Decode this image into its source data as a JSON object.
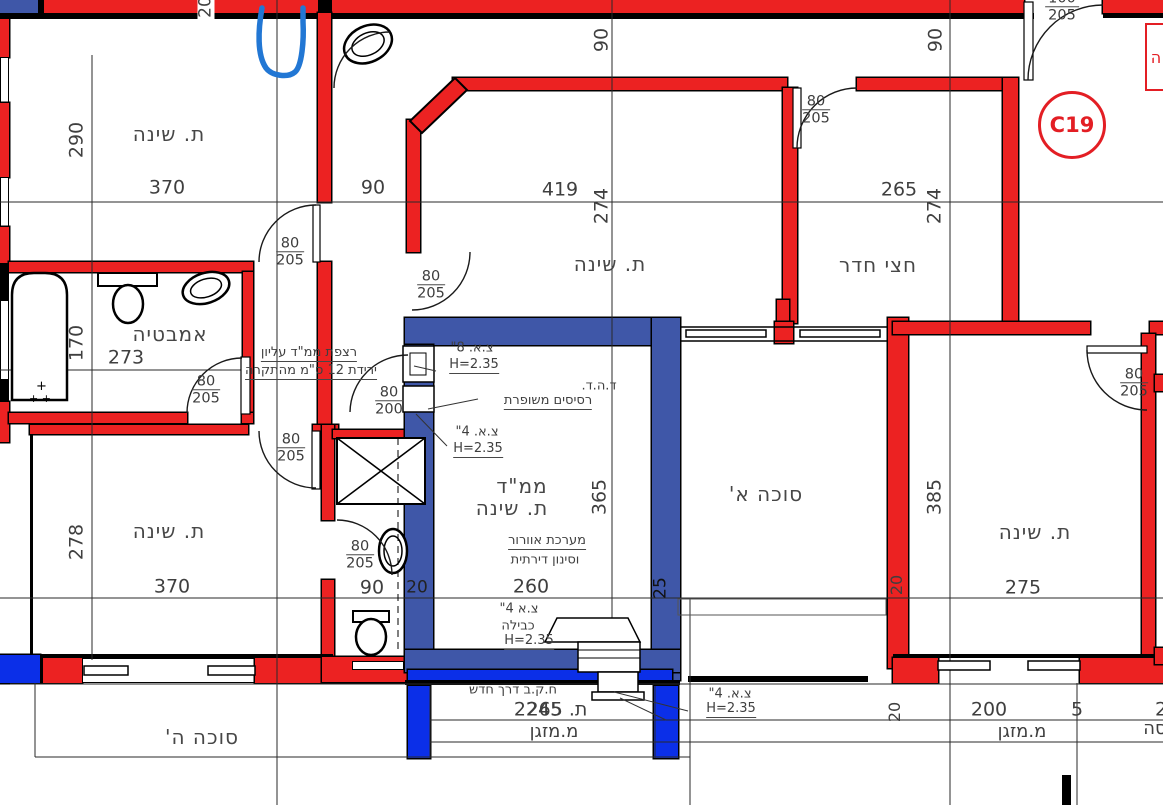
{
  "colors": {
    "wall_red": "#ec2222",
    "wall_blue": "#3f57a8",
    "wall_blue_bright": "#0b2fe8",
    "marker_red": "#e31e24",
    "sketch_blue": "#2277d4"
  },
  "marker": {
    "label": "C19",
    "partial_right_box": "ה"
  },
  "rooms": {
    "bedroom_top_left": {
      "label": "ת. שינה"
    },
    "bedroom_middle": {
      "label": "ת. שינה"
    },
    "half_room": {
      "label": "חצי חדר"
    },
    "bathroom": {
      "label": "אמבטיה"
    },
    "bedroom_bottom_left": {
      "label": "ת. שינה"
    },
    "bedroom_right": {
      "label": "ת. שינה"
    },
    "mamad": {
      "label_line1": "ממ\"ד",
      "label_line2": "ת. שינה"
    },
    "sukkah_a": {
      "label": "סוכה א'"
    },
    "sukkah_h": {
      "label": "סוכה ה'"
    },
    "ac_left": {
      "label": "מ.מזגן"
    },
    "ac_right": {
      "label": "מ.מזגן"
    }
  },
  "door_sizes": {
    "standard_width": "80",
    "standard_height": "205",
    "mamad_height": "200",
    "entry_width": "100"
  },
  "dims": {
    "tl_w": "370",
    "tl_h": "290",
    "tl_gap": "90",
    "top_cut": "20",
    "mid_w": "419",
    "mid_h": "274",
    "mid_top": "90",
    "half_w": "265",
    "half_h": "274",
    "right_top": "90",
    "bath_w": "273",
    "bath_h": "170",
    "bl_w": "370",
    "bl_h": "278",
    "mamad_w": "260",
    "mamad_h": "365",
    "mamad_side": "25",
    "wc_w": "90",
    "wc_side": "20",
    "r_w": "275",
    "r_h": "385",
    "r_wall": "20",
    "br_w": "200",
    "br_gap": "5",
    "br_cut": "2",
    "br_wall": "20",
    "bottom_left_overlap_a": "2245",
    "bottom_left_overlap_b": "ת. 265"
  },
  "annotations": {
    "floor_note_line1": "רצפת ממ\"ד עליון",
    "floor_note_line2": "ירידת 12 ס\"מ מהתקרה",
    "pipe8": "צ.א. 8\"",
    "h235": "H=2.35",
    "door_note_line1": "ד.ה.ד.",
    "door_note_line2": "רסיסים משופרת",
    "pipe4": "צ.א. 4\"",
    "vent_line1": "מערכת אוורור",
    "vent_line2": "וסינון דירתית",
    "cable_line1": "צ.א 4\"",
    "cable_line2": "כבילה",
    "window_note": "ח.ק.ב דרך חדש",
    "partial_right": "סה"
  }
}
